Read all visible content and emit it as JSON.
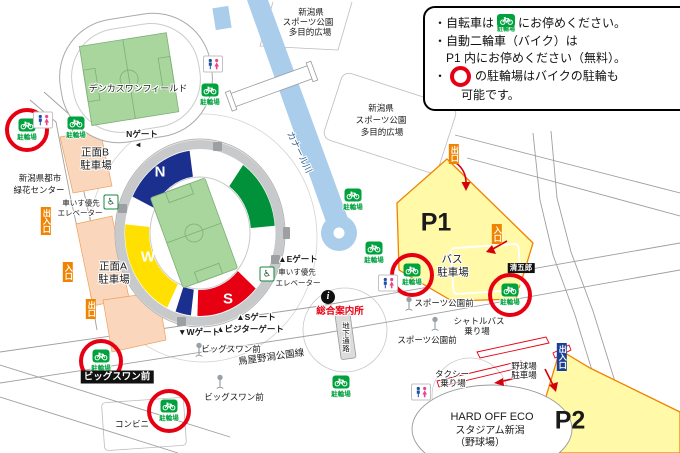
{
  "legend": {
    "line1_pre": "・自転車は",
    "line1_post": "にお停めください。",
    "line2a": "・自動二輪車（バイク）は",
    "line2b": "P1 内にお停めください（無料）。",
    "line3_bullet": "・",
    "line3a": "の駐輪場はバイクの駐輪も",
    "line3b": "可能です。",
    "bike_icon_label": "駐輪場"
  },
  "colors": {
    "bike_green": "#00A23E",
    "highlight_red": "#E60012",
    "parking_yellow": "#FFF9A8",
    "parking_border": "#F08300",
    "stand_north_blue": "#1B2F8E",
    "stand_east_green": "#00913A",
    "stand_south_red": "#E60012",
    "stand_west_yellow": "#FFE000",
    "canal_blue": "#A9CDEB",
    "lot_peach": "#FAD7BC",
    "badge_orange": "#F08300",
    "badge_blue": "#1B3F94"
  },
  "map": {
    "bike_label": "駐輪場",
    "bike_parkings": [
      {
        "x": 27,
        "y": 125,
        "circled": true
      },
      {
        "x": 76,
        "y": 123,
        "circled": false
      },
      {
        "x": 210,
        "y": 90,
        "circled": false
      },
      {
        "x": 353,
        "y": 195,
        "circled": false
      },
      {
        "x": 374,
        "y": 248,
        "circled": false
      },
      {
        "x": 412,
        "y": 270,
        "circled": true
      },
      {
        "x": 510,
        "y": 290,
        "circled": true
      },
      {
        "x": 341,
        "y": 382,
        "circled": false
      },
      {
        "x": 101,
        "y": 356,
        "circled": true
      },
      {
        "x": 169,
        "y": 406,
        "circled": true
      }
    ],
    "restrooms": [
      {
        "x": 213,
        "y": 64
      },
      {
        "x": 43,
        "y": 120
      },
      {
        "x": 388,
        "y": 283
      },
      {
        "x": 421,
        "y": 392
      }
    ],
    "bus_stops": [
      {
        "x": 199,
        "y": 350
      },
      {
        "x": 220,
        "y": 382
      },
      {
        "x": 409,
        "y": 304
      },
      {
        "x": 435,
        "y": 324
      }
    ],
    "wheelchair_icons": [
      {
        "x": 111,
        "y": 202
      },
      {
        "x": 267,
        "y": 274
      }
    ],
    "info_icon": {
      "x": 328,
      "y": 297,
      "glyph": "i"
    },
    "badges": [
      {
        "t": "出入口",
        "x": 46,
        "y": 221,
        "k": "orange",
        "vert": true
      },
      {
        "t": "入口",
        "x": 68,
        "y": 272,
        "k": "orange",
        "vert": true
      },
      {
        "t": "出口",
        "x": 91,
        "y": 309,
        "k": "orange",
        "vert": true
      },
      {
        "t": "出口",
        "x": 454,
        "y": 154,
        "k": "orange",
        "vert": true
      },
      {
        "t": "入口",
        "x": 497,
        "y": 234,
        "k": "orange",
        "vert": true
      },
      {
        "t": "出入口",
        "x": 562,
        "y": 357,
        "k": "blue",
        "vert": true
      },
      {
        "t": "ビッグスワン前",
        "x": 117,
        "y": 377,
        "k": "black"
      },
      {
        "t": "清五郎",
        "x": 521,
        "y": 268,
        "k": "blacksm"
      }
    ],
    "labels": [
      {
        "name": "denka-field-label",
        "t": "デンカスワンフィールド",
        "x": 138,
        "y": 88,
        "s": 9
      },
      {
        "name": "plaza-label",
        "t": "新潟県",
        "x": 311,
        "y": 12
      },
      {
        "name": "plaza-label",
        "t": "スポーツ公園",
        "x": 308,
        "y": 22
      },
      {
        "name": "plaza-label",
        "t": "多目的広場",
        "x": 310,
        "y": 32
      },
      {
        "name": "plaza-label",
        "t": "新潟県",
        "x": 381,
        "y": 108
      },
      {
        "name": "plaza-label",
        "t": "スポーツ公園",
        "x": 381,
        "y": 120
      },
      {
        "name": "plaza-label",
        "t": "多目的広場",
        "x": 382,
        "y": 132
      },
      {
        "name": "greenery-center-label",
        "t": "新潟県都市",
        "x": 40,
        "y": 178
      },
      {
        "name": "greenery-center-label",
        "t": "緑花センター",
        "x": 39,
        "y": 190
      },
      {
        "name": "lot-b-label",
        "t": "正面B",
        "x": 95,
        "y": 152,
        "s": 10.5
      },
      {
        "name": "lot-b-label",
        "t": "駐車場",
        "x": 96,
        "y": 165,
        "s": 10.5
      },
      {
        "name": "lot-a-label",
        "t": "正面A",
        "x": 113,
        "y": 266,
        "s": 10.5
      },
      {
        "name": "lot-a-label",
        "t": "駐車場",
        "x": 114,
        "y": 279,
        "s": 10.5
      },
      {
        "name": "gate-n-label",
        "t": "Nゲート",
        "x": 142,
        "y": 134,
        "b": true
      },
      {
        "name": "gate-n-pointer",
        "t": "◀",
        "x": 138,
        "y": 145,
        "s": 6
      },
      {
        "name": "gate-e-label",
        "t": "▲Eゲート",
        "x": 298,
        "y": 259,
        "b": true
      },
      {
        "name": "elevator-label",
        "t": "車いす優先",
        "x": 81,
        "y": 203,
        "s": 7.5
      },
      {
        "name": "elevator-label",
        "t": "エレベーター",
        "x": 80,
        "y": 213,
        "s": 7.5
      },
      {
        "name": "elevator-label",
        "t": "車いす優先",
        "x": 297,
        "y": 272,
        "s": 7.5
      },
      {
        "name": "elevator-label",
        "t": "エレベーター",
        "x": 298,
        "y": 283,
        "s": 7.5
      },
      {
        "name": "gate-s-label",
        "t": "▲Sゲート",
        "x": 256,
        "y": 317,
        "b": true
      },
      {
        "name": "gate-visitor-label",
        "t": "▲ビジターゲート",
        "x": 250,
        "y": 329,
        "b": true
      },
      {
        "name": "gate-w-label",
        "t": "▼Wゲート",
        "x": 199,
        "y": 332,
        "b": true
      },
      {
        "name": "info-center-label",
        "t": "総合案内所",
        "x": 340,
        "y": 310,
        "s": 9.5,
        "b": true,
        "c": "#E60012"
      },
      {
        "name": "underpass-label",
        "t": "地下通路",
        "x": 346,
        "y": 337,
        "s": 7.5,
        "vert": true
      },
      {
        "name": "canal-label",
        "t": "カナール川",
        "x": 300,
        "y": 152,
        "s": 9,
        "c": "#33608F",
        "r": 64
      },
      {
        "name": "road-name-label",
        "t": "鳥屋野潟公園線",
        "x": 271,
        "y": 356,
        "s": 9.5,
        "r": -8
      },
      {
        "name": "bus-stop-label",
        "t": "ビッグスワン前",
        "x": 231,
        "y": 349
      },
      {
        "name": "bus-stop-label",
        "t": "ビッグスワン前",
        "x": 234,
        "y": 397
      },
      {
        "name": "bus-stop-label",
        "t": "スポーツ公園前",
        "x": 444,
        "y": 303
      },
      {
        "name": "bus-stop-label",
        "t": "スポーツ公園前",
        "x": 427,
        "y": 340
      },
      {
        "name": "shuttle-bus-label",
        "t": "シャトルバス",
        "x": 479,
        "y": 321
      },
      {
        "name": "shuttle-bus-label",
        "t": "乗り場",
        "x": 477,
        "y": 331
      },
      {
        "name": "taxi-label",
        "t": "タクシー",
        "x": 452,
        "y": 374
      },
      {
        "name": "taxi-label",
        "t": "乗り場",
        "x": 453,
        "y": 383
      },
      {
        "name": "baseball-parking-label",
        "t": "野球場",
        "x": 524,
        "y": 366
      },
      {
        "name": "baseball-parking-label",
        "t": "駐車場",
        "x": 524,
        "y": 375
      },
      {
        "name": "convenience-store-label",
        "t": "コンビニ",
        "x": 132,
        "y": 424
      },
      {
        "name": "p1-label",
        "t": "P1",
        "x": 436,
        "y": 223,
        "s": 25,
        "b": true,
        "halo": false
      },
      {
        "name": "p2-label",
        "t": "P2",
        "x": 570,
        "y": 421,
        "s": 25,
        "b": true,
        "halo": false
      },
      {
        "name": "bus-parking-label",
        "t": "バス",
        "x": 452,
        "y": 259,
        "s": 10.5
      },
      {
        "name": "bus-parking-label",
        "t": "駐車場",
        "x": 453,
        "y": 272,
        "s": 10.5
      },
      {
        "name": "eco-stadium-label",
        "t": "HARD OFF ECO",
        "x": 492,
        "y": 417,
        "s": 11
      },
      {
        "name": "eco-stadium-label",
        "t": "スタジアム新潟",
        "x": 490,
        "y": 429,
        "s": 10
      },
      {
        "name": "eco-stadium-label",
        "t": "（野球場）",
        "x": 480,
        "y": 441,
        "s": 10
      },
      {
        "name": "stand-n-letter",
        "t": "N",
        "x": 160,
        "y": 172,
        "s": 15,
        "b": true,
        "c": "#fff",
        "halo": false
      },
      {
        "name": "stand-e-letter",
        "t": "E",
        "x": 238,
        "y": 211,
        "s": 15,
        "b": true,
        "c": "#fff",
        "halo": false
      },
      {
        "name": "stand-w-letter",
        "t": "W",
        "x": 148,
        "y": 257,
        "s": 15,
        "b": true,
        "c": "#fff",
        "halo": false
      },
      {
        "name": "stand-s-letter",
        "t": "S",
        "x": 228,
        "y": 299,
        "s": 15,
        "b": true,
        "c": "#fff",
        "halo": false
      }
    ]
  }
}
